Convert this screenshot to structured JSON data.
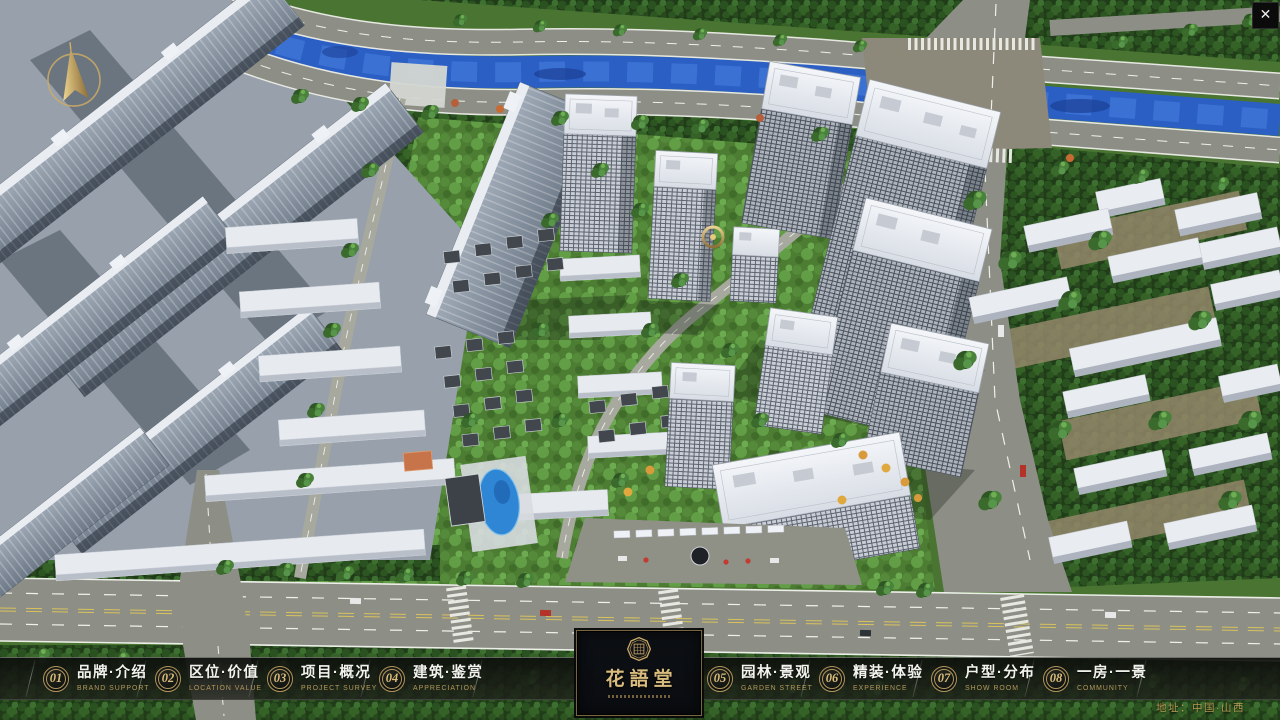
{
  "app": {
    "close_glyph": "✕"
  },
  "logo": {
    "name": "花語堂"
  },
  "nav": {
    "items": [
      {
        "num": "01",
        "zh": "品牌·介绍",
        "en": "BRAND SUPPORT"
      },
      {
        "num": "02",
        "zh": "区位·价值",
        "en": "LOCATION VALUE"
      },
      {
        "num": "03",
        "zh": "项目·概况",
        "en": "PROJECT SURVEY"
      },
      {
        "num": "04",
        "zh": "建筑·鉴赏",
        "en": "APPRECIATION"
      },
      {
        "num": "05",
        "zh": "园林·景观",
        "en": "GARDEN STREET"
      },
      {
        "num": "06",
        "zh": "精装·体验",
        "en": "EXPERIENCE"
      },
      {
        "num": "07",
        "zh": "户型·分布",
        "en": "SHOW ROOM"
      },
      {
        "num": "08",
        "zh": "一房·一景",
        "en": "COMMUNITY"
      }
    ]
  },
  "footer": {
    "address": "地址：中国·山西"
  },
  "colors": {
    "accent_gold": "#c9a764",
    "nav_bg": "#12140f",
    "river_blue": "#2b5fc4",
    "road_gray": "#8d8f86"
  }
}
